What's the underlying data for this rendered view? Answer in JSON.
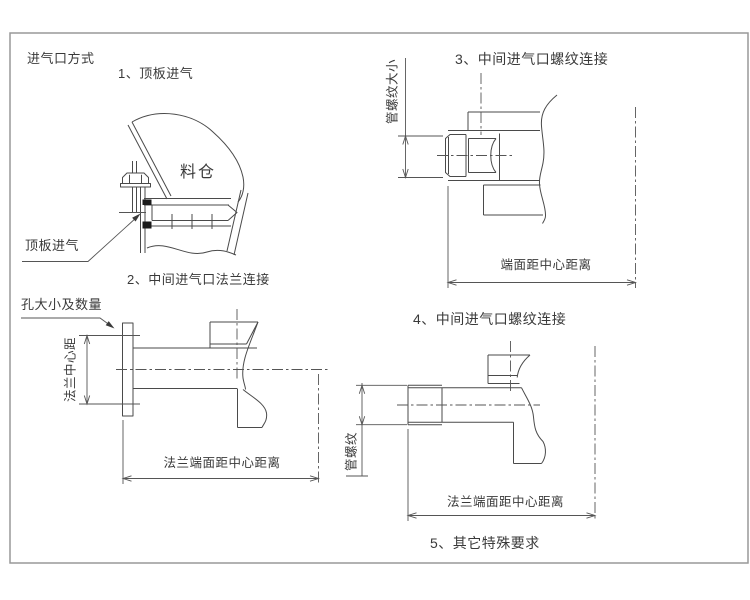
{
  "drawing": {
    "title": "进气口方式",
    "sections": [
      {
        "id": "1",
        "title": "1、顶板进气",
        "labels": {
          "bin": "料仓",
          "callout": "顶板进气"
        }
      },
      {
        "id": "2",
        "title": "2、中间进气口法兰连接",
        "labels": {
          "callout": "孔大小及数量",
          "vertical_dim": "法兰中心距",
          "horizontal_dim": "法兰端面距中心距离"
        }
      },
      {
        "id": "3",
        "title": "3、中间进气口螺纹连接",
        "labels": {
          "vertical_dim": "管螺纹大小",
          "horizontal_dim": "端面距中心距离"
        }
      },
      {
        "id": "4",
        "title": "4、中间进气口螺纹连接",
        "labels": {
          "vertical_dim": "管螺纹",
          "horizontal_dim": "法兰端面距中心距离"
        }
      },
      {
        "id": "5",
        "title": "5、其它特殊要求"
      }
    ],
    "colors": {
      "line": "#4a4a4a",
      "dimension_line": "#555555",
      "text": "#3a3a3a",
      "frame": "#999999",
      "background": "#ffffff",
      "seal_fill": "#1a1a1a"
    }
  }
}
